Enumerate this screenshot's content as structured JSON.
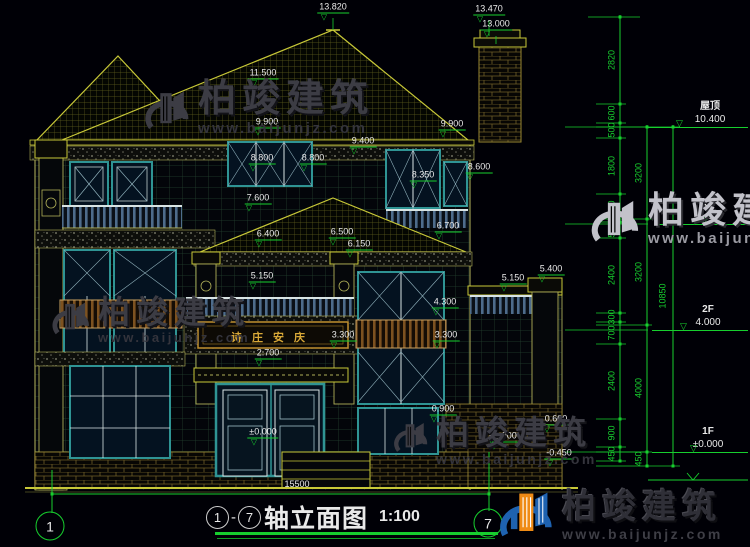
{
  "watermark": {
    "brand": "柏竣建筑",
    "site": "www.baijunjz.com"
  },
  "title": {
    "axis_from": "1",
    "axis_to": "7",
    "dash": "-",
    "name": "轴立面图",
    "scale": "1:100"
  },
  "plaque": {
    "text": "诗庄安庆"
  },
  "axis_bubbles": [
    {
      "label": "1",
      "x": 50,
      "y": 526
    },
    {
      "label": "7",
      "x": 488,
      "y": 523
    }
  ],
  "levels": [
    {
      "name": "屋顶",
      "value": "10.400",
      "x": 648,
      "w": 100,
      "line_y": 127,
      "tx": 62,
      "tri": 28
    },
    {
      "name": "3F",
      "value": "7.200",
      "x": 655,
      "w": 93,
      "line_y": 224,
      "tx": 55,
      "tri": 46
    },
    {
      "name": "2F",
      "value": "4.000",
      "x": 652,
      "w": 96,
      "line_y": 330,
      "tx": 56,
      "tri": 28
    },
    {
      "name": "1F",
      "value": "±0.000",
      "x": 652,
      "w": 96,
      "line_y": 452,
      "tx": 56,
      "tri": 38
    }
  ],
  "elevation_marks": [
    {
      "t": "13.820",
      "x": 333,
      "y": 12
    },
    {
      "t": "13.470",
      "x": 489,
      "y": 14
    },
    {
      "t": "13.000",
      "x": 496,
      "y": 29
    },
    {
      "t": "11.500",
      "x": 263,
      "y": 78
    },
    {
      "t": "9.900",
      "x": 267,
      "y": 127
    },
    {
      "t": "9.900",
      "x": 452,
      "y": 129
    },
    {
      "t": "9.400",
      "x": 363,
      "y": 146
    },
    {
      "t": "8.800",
      "x": 262,
      "y": 163
    },
    {
      "t": "8.800",
      "x": 313,
      "y": 163
    },
    {
      "t": "8.600",
      "x": 479,
      "y": 172
    },
    {
      "t": "8.350",
      "x": 423,
      "y": 180
    },
    {
      "t": "7.600",
      "x": 258,
      "y": 203
    },
    {
      "t": "6.700",
      "x": 448,
      "y": 231
    },
    {
      "t": "6.500",
      "x": 342,
      "y": 237
    },
    {
      "t": "6.400",
      "x": 268,
      "y": 239
    },
    {
      "t": "6.150",
      "x": 359,
      "y": 249
    },
    {
      "t": "5.400",
      "x": 551,
      "y": 274
    },
    {
      "t": "5.150",
      "x": 262,
      "y": 281
    },
    {
      "t": "5.150",
      "x": 513,
      "y": 283
    },
    {
      "t": "4.300",
      "x": 445,
      "y": 307
    },
    {
      "t": "3.300",
      "x": 343,
      "y": 340
    },
    {
      "t": "3.300",
      "x": 446,
      "y": 340
    },
    {
      "t": "2.700",
      "x": 268,
      "y": 358
    },
    {
      "t": "0.900",
      "x": 443,
      "y": 414
    },
    {
      "t": "0.600",
      "x": 556,
      "y": 424
    },
    {
      "t": "±0.000",
      "x": 263,
      "y": 437
    },
    {
      "t": "±0.000",
      "x": 503,
      "y": 441
    },
    {
      "t": "-0.450",
      "x": 559,
      "y": 458
    },
    {
      "t": "15500",
      "x": 297,
      "y": 485,
      "plain": true
    }
  ],
  "chain_labels": [
    {
      "t": "2820",
      "x": 612,
      "y": 60
    },
    {
      "t": "600",
      "x": 612,
      "y": 113
    },
    {
      "t": "500",
      "x": 612,
      "y": 130
    },
    {
      "t": "1800",
      "x": 612,
      "y": 166
    },
    {
      "t": "900",
      "x": 612,
      "y": 208
    },
    {
      "t": "500",
      "x": 612,
      "y": 230
    },
    {
      "t": "2400",
      "x": 612,
      "y": 275
    },
    {
      "t": "300",
      "x": 612,
      "y": 317
    },
    {
      "t": "700",
      "x": 612,
      "y": 333
    },
    {
      "t": "2400",
      "x": 612,
      "y": 381
    },
    {
      "t": "900",
      "x": 612,
      "y": 433
    },
    {
      "t": "450",
      "x": 612,
      "y": 454
    },
    {
      "t": "3200",
      "x": 639,
      "y": 173
    },
    {
      "t": "3200",
      "x": 639,
      "y": 272
    },
    {
      "t": "4000",
      "x": 639,
      "y": 388
    },
    {
      "t": "450",
      "x": 639,
      "y": 459
    },
    {
      "t": "10850",
      "x": 663,
      "y": 296
    }
  ]
}
